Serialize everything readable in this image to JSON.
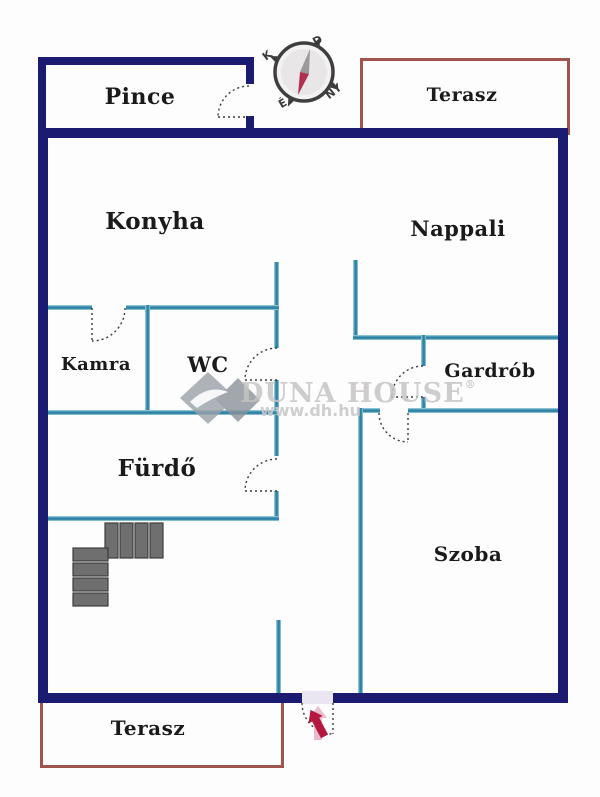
{
  "rooms": [
    {
      "id": "pince",
      "label": "Pince"
    },
    {
      "id": "terasz-top",
      "label": "Terasz"
    },
    {
      "id": "konyha",
      "label": "Konyha"
    },
    {
      "id": "nappali",
      "label": "Nappali"
    },
    {
      "id": "kamra",
      "label": "Kamra"
    },
    {
      "id": "wc",
      "label": "WC"
    },
    {
      "id": "gardrob",
      "label": "Gardrób"
    },
    {
      "id": "furdo",
      "label": "Fürdő"
    },
    {
      "id": "szoba",
      "label": "Szoba"
    },
    {
      "id": "terasz-bottom",
      "label": "Terasz"
    }
  ],
  "compass": {
    "east": "K",
    "south": "D",
    "west": "NY",
    "north": "É"
  },
  "watermark": {
    "brand": "DUNA HOUSE",
    "registered": "®",
    "url": "www.dh.hu"
  },
  "colors": {
    "outer_wall": "#1b1b72",
    "inner_wall": "#3a8cab",
    "terrace_border": "#a0544e",
    "entry_arrow": "#b5173f",
    "stairs": "#6f6f6f",
    "watermark_text": "#c6c4c4",
    "room_label": "#1a1a1a"
  }
}
